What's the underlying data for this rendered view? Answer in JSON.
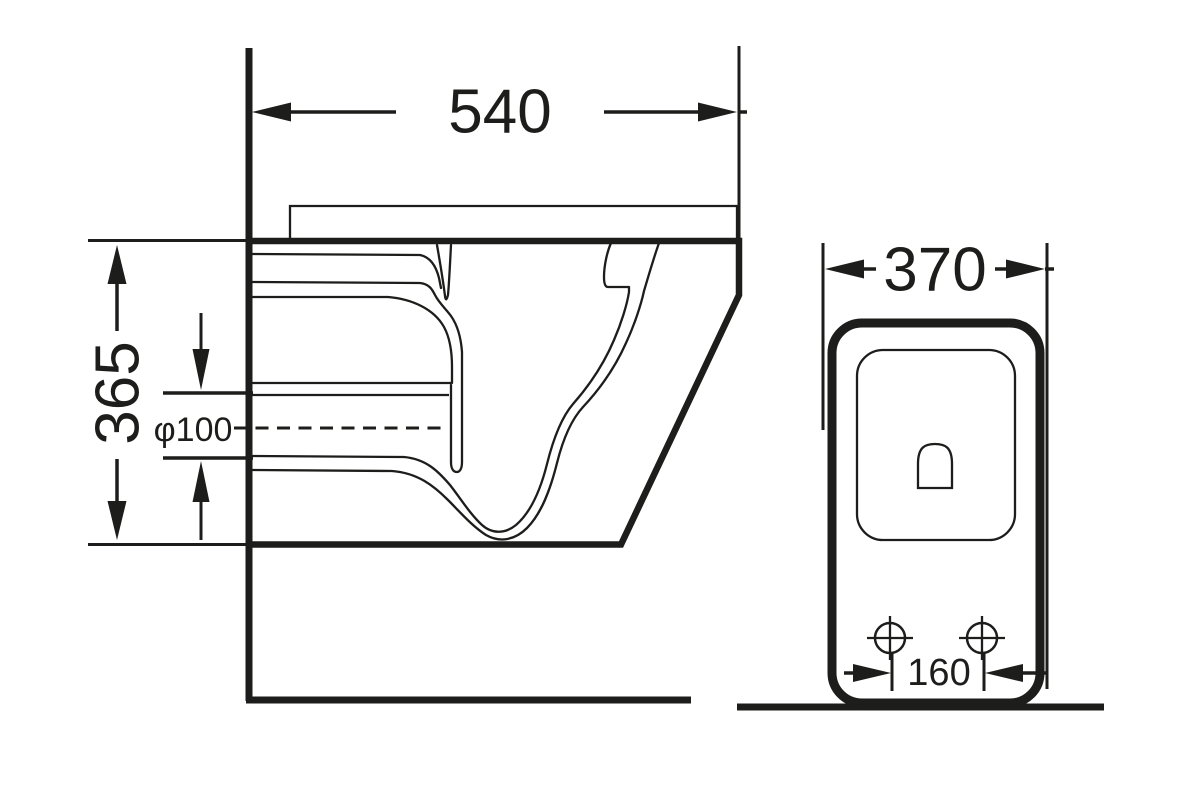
{
  "colors": {
    "ink": "#1d1d1b",
    "background": "#ffffff"
  },
  "side_view": {
    "width_label": "540",
    "height_label": "365",
    "outlet_diameter_label": "φ100"
  },
  "front_view": {
    "width_label": "370",
    "bolt_spacing_label": "160"
  }
}
